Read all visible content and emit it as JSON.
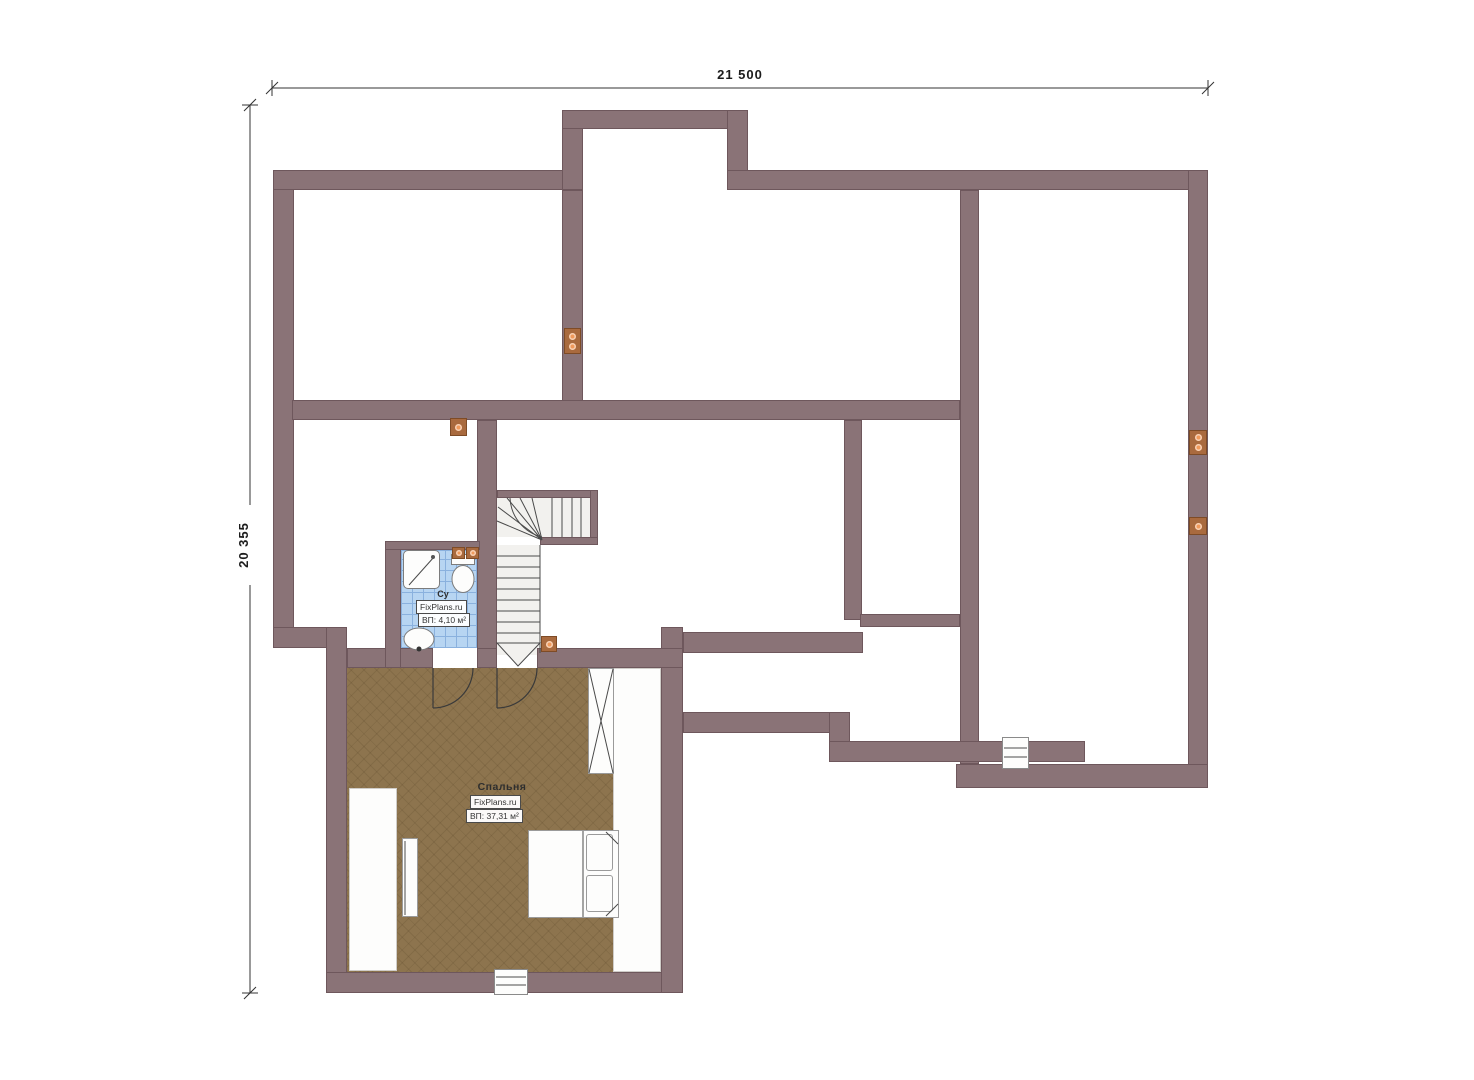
{
  "dimensions": {
    "width": "21 500",
    "height": "20 355"
  },
  "rooms": {
    "bedroom": {
      "name": "Спальня",
      "brand": "FixPlans.ru",
      "area": "ВП: 37,31 м²"
    },
    "bathroom": {
      "name": "Су",
      "brand": "FixPlans.ru",
      "area": "ВП: 4,10 м²"
    }
  },
  "symbols": {
    "socket": "power-socket-icon",
    "window": "window-symbol",
    "door": "door-swing-symbol",
    "stairs": "staircase-symbol"
  },
  "colors": {
    "wall": "#8a7377",
    "wall_edge": "#6e575c",
    "floor": "#8d744e",
    "floor_line": "#6f5637",
    "tile": "#b7d5f2",
    "tile_line": "#8ab1de",
    "stair": "#f2f1ee",
    "stroke": "#4a4a4a",
    "socket": "#a96a3e",
    "socket_dot": "#f09a5c",
    "dim": "#333333"
  }
}
